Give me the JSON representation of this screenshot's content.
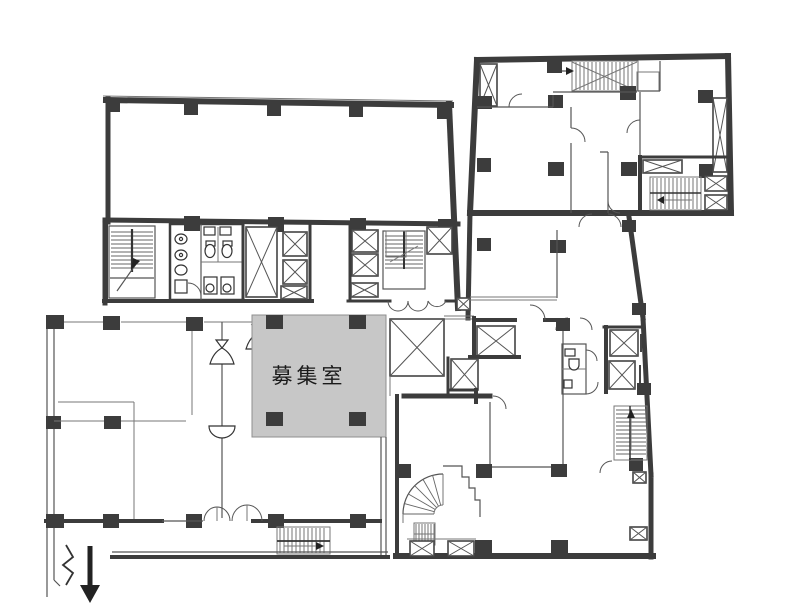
{
  "plan": {
    "vacant_room_label": "募集室",
    "colors": {
      "wall": "#3c3c3c",
      "vacant_room_fill": "#c7c7c7",
      "background": "#ffffff",
      "line": "#555555"
    },
    "symbols": [
      "elevator-shaft",
      "staircase",
      "spiral-staircase",
      "wc-fixtures",
      "double-door",
      "entrance-arrow",
      "column",
      "cone-marker",
      "break-line"
    ]
  }
}
